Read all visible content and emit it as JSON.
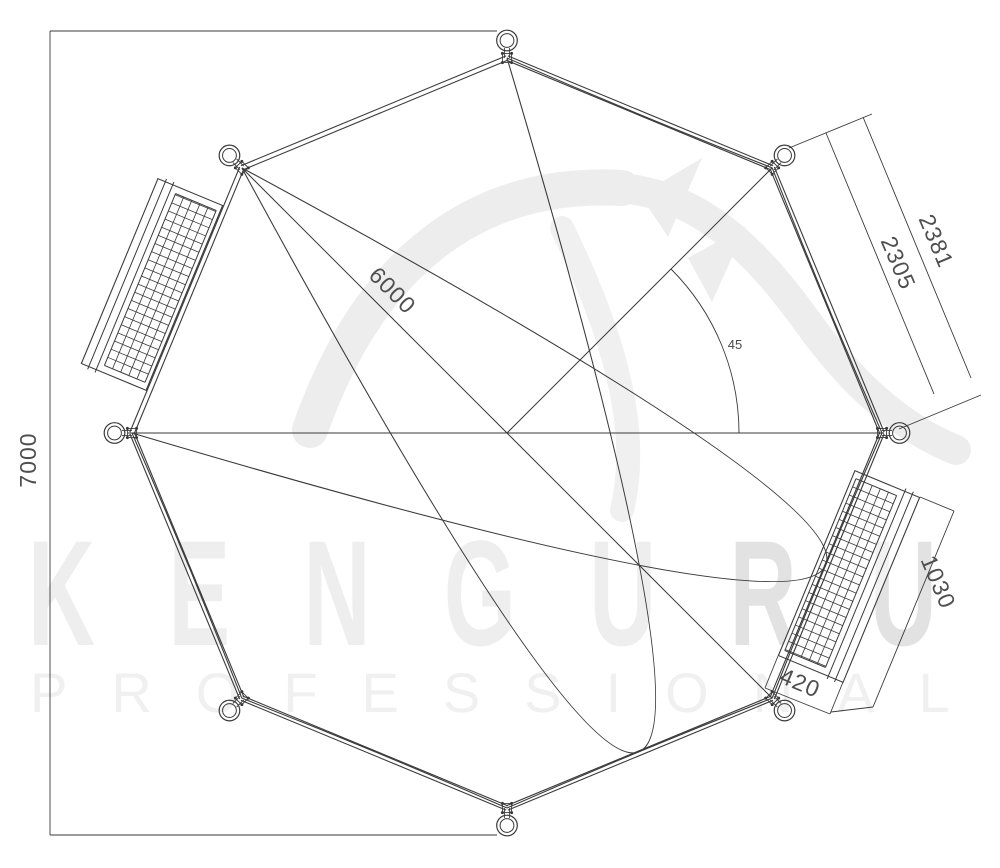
{
  "watermark": {
    "brand_left": "KENGU",
    "brand_right": "RU",
    "tagline": "PROFESSIONAL"
  },
  "dimensions": {
    "overall_height": "7000",
    "mat_diameter": "6000",
    "segment_outer": "2381",
    "segment_inner": "2305",
    "platform_length": "1030",
    "platform_width": "420",
    "angle_deg": "45"
  },
  "colors": {
    "drawing_line": "#3a3a3a",
    "dimension_text": "#4f4f4f",
    "watermark_light": "#eeeeee",
    "watermark_dark": "#e2e2e2",
    "background": "#ffffff"
  }
}
